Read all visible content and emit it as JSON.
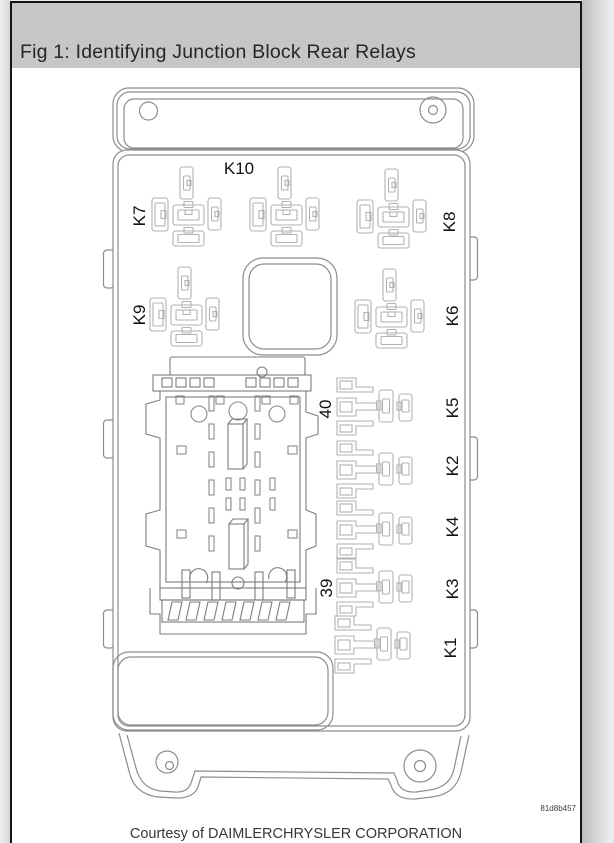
{
  "figure": {
    "title": "Fig 1: Identifying Junction Block Rear Relays",
    "courtesy": "Courtesy of DAIMLERCHRYSLER CORPORATION",
    "graphic_id": "81d8b457"
  },
  "diagram": {
    "description": "Junction block rear view line drawing with relay cavity labels",
    "labels": [
      {
        "id": "K10"
      },
      {
        "id": "K7"
      },
      {
        "id": "K8"
      },
      {
        "id": "K9"
      },
      {
        "id": "K6"
      },
      {
        "id": "K5"
      },
      {
        "id": "40"
      },
      {
        "id": "K2"
      },
      {
        "id": "K4"
      },
      {
        "id": "K3"
      },
      {
        "id": "39"
      },
      {
        "id": "K1"
      }
    ],
    "colors": {
      "header_bar": "#c6c6c6",
      "page_border": "#141414",
      "body_outline": "#8d8d8d",
      "slot_outline": "#b2b2b2",
      "connector_outline": "#7c7c7c",
      "label_text": "#111111"
    }
  }
}
